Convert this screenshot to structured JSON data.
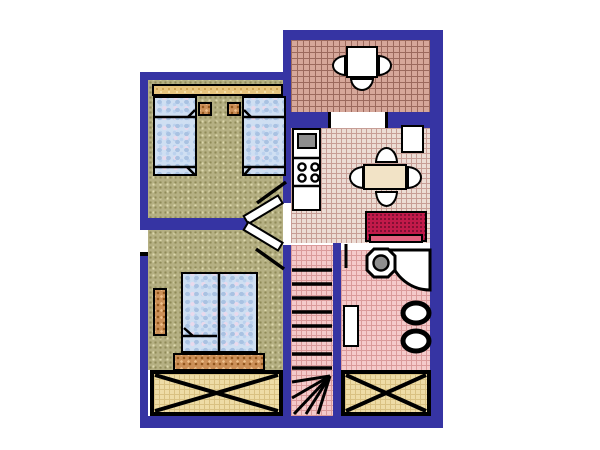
{
  "title": "apartment-floor-plan",
  "colors": {
    "wall": "#3634a3",
    "outline": "#000000",
    "background": "#ffffff",
    "floor_main": "#b5b083",
    "floor_kitchen": "#ecdcd4",
    "floor_bath": "#f4caca",
    "floor_terrace": "#d6a79a",
    "floor_balcony": "#eedca6",
    "red_furniture": "#c21a4a",
    "red_furniture_light": "#e2607e",
    "wood": "#cc9058",
    "tan_shelf": "#e8c57e",
    "bed_fabric": "#cfdff2",
    "gray_appliance": "#8e8e8e",
    "fixture_white": "#ffffff"
  },
  "rooms": [
    {
      "id": "terrace",
      "label": "upper terrace",
      "floor": "salmon grid",
      "furniture": [
        "square-table",
        "chair-left",
        "chair-right",
        "chair-bottom"
      ]
    },
    {
      "id": "bedroom",
      "label": "bedroom",
      "floor": "olive speckle",
      "furniture": [
        "wardrobe-shelf",
        "single-bed-left",
        "single-bed-right",
        "nightstand-left",
        "nightstand-right",
        "door"
      ]
    },
    {
      "id": "kitchen-dining",
      "label": "kitchen / dining room",
      "floor": "rose grid",
      "furniture": [
        "kitchen-unit",
        "sink-basin",
        "stove-top-4-burners",
        "lower-cabinet",
        "dining-table",
        "chair-top",
        "chair-bottom",
        "chair-left",
        "chair-right",
        "side-table",
        "red-sideboard"
      ]
    },
    {
      "id": "bathroom",
      "label": "bathroom",
      "floor": "pink grid",
      "furniture": [
        "washbasin-octagon",
        "corner-shower-tub",
        "toilet",
        "bidet",
        "radiator",
        "door-leaf"
      ]
    },
    {
      "id": "living-room",
      "label": "living room",
      "floor": "olive speckle",
      "furniture": [
        "double-bed",
        "foot-bench",
        "tall-cabinet",
        "window-left-wall",
        "door"
      ]
    },
    {
      "id": "staircase",
      "label": "winder staircase",
      "floor": "pink grid",
      "furniture": [
        "eight-straight-steps",
        "fanned-winder-steps"
      ]
    },
    {
      "id": "balcony-left",
      "label": "lower balcony left (crossed)",
      "floor": "wheat grid",
      "furniture": []
    },
    {
      "id": "balcony-right",
      "label": "lower balcony right (crossed)",
      "floor": "wheat grid",
      "furniture": []
    }
  ],
  "openings": [
    {
      "id": "window-left-wall",
      "wall": "left"
    },
    {
      "id": "terrace-door",
      "wall": "between terrace and kitchen"
    },
    {
      "id": "hall-passage",
      "wall": "between landing and kitchen"
    },
    {
      "id": "bathroom-door",
      "wall": "between hall and bathroom"
    },
    {
      "id": "bedroom-door",
      "wall": "landing"
    },
    {
      "id": "living-room-door",
      "wall": "landing"
    }
  ]
}
